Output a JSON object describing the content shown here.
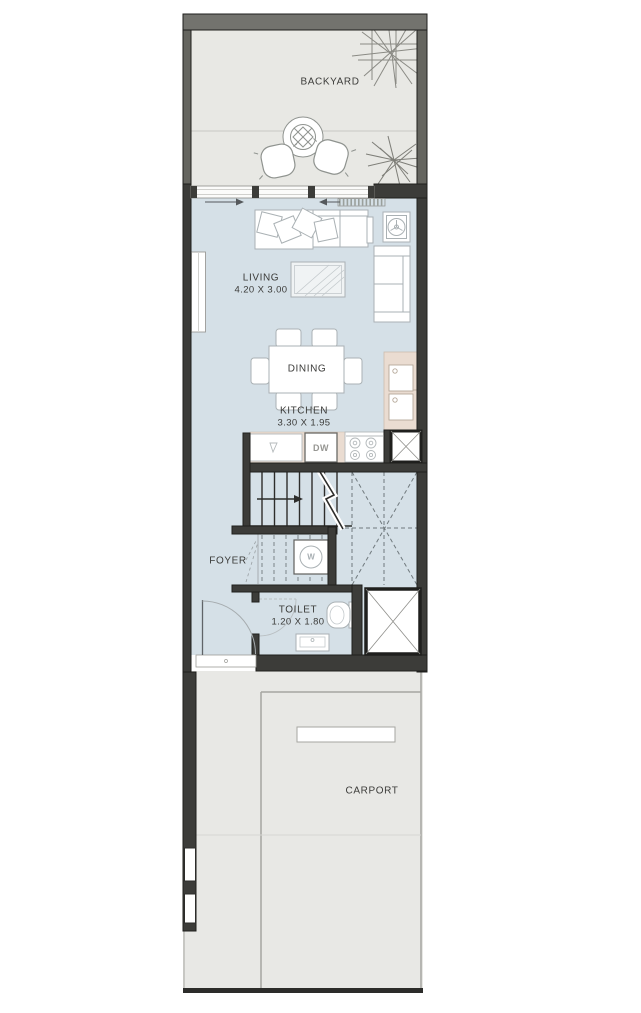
{
  "plan_title": "Townhouse ground floor plan",
  "rooms": {
    "backyard": {
      "label": "BACKYARD"
    },
    "living": {
      "label": "LIVING",
      "dims": "4.20 X 3.00"
    },
    "dining": {
      "label": "DINING"
    },
    "kitchen": {
      "label": "KITCHEN",
      "dims": "3.30 X 1.95"
    },
    "foyer": {
      "label": "FOYER"
    },
    "toilet": {
      "label": "TOILET",
      "dims": "1.20 X 1.80"
    },
    "carport": {
      "label": "CARPORT"
    }
  },
  "appliances": {
    "dishwasher": "DW",
    "washer": "W"
  },
  "colors": {
    "wall": "#3c3c39",
    "backyard_wall": "#73736e",
    "interior_floor": "#d5e0e7",
    "backyard_floor": "#e8e8e4",
    "carport_floor": "#e8e8e5",
    "kitchen_counter": "#eadcd1",
    "furniture_outline": "#aab1b4",
    "dashed_line": "#70797d"
  }
}
